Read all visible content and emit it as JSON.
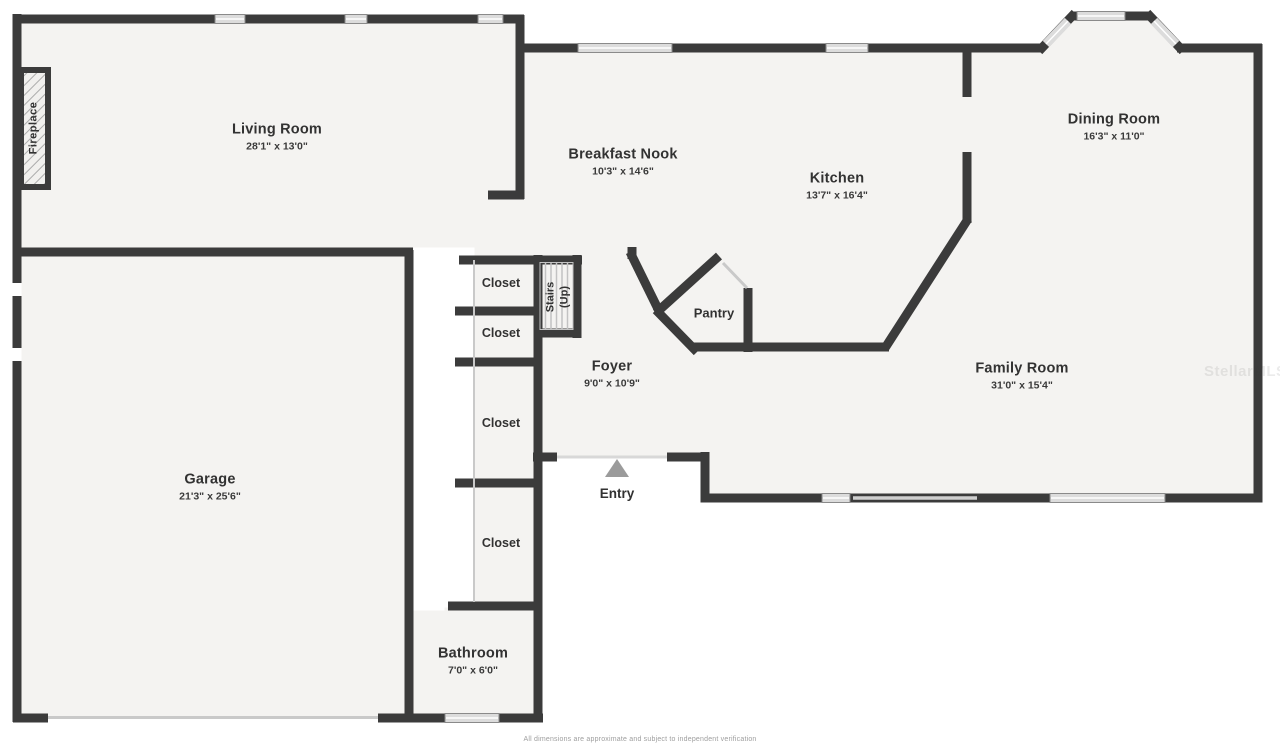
{
  "plan": {
    "rooms": [
      {
        "name": "Living Room",
        "dims": "28'1\" x 13'0\""
      },
      {
        "name": "Breakfast Nook",
        "dims": "10'3\" x 14'6\""
      },
      {
        "name": "Kitchen",
        "dims": "13'7\" x 16'4\""
      },
      {
        "name": "Dining Room",
        "dims": "16'3\" x 11'0\""
      },
      {
        "name": "Family Room",
        "dims": "31'0\" x 15'4\""
      },
      {
        "name": "Foyer",
        "dims": "9'0\" x 10'9\""
      },
      {
        "name": "Garage",
        "dims": "21'3\" x 25'6\""
      },
      {
        "name": "Bathroom",
        "dims": "7'0\" x 6'0\""
      }
    ],
    "pantry_label": "Pantry",
    "entry_label": "Entry",
    "closet_label": "Closet",
    "stairs_line1": "Stairs",
    "stairs_line2": "(Up)",
    "fireplace_label": "Fireplace",
    "watermark": "StellarMLS",
    "disclaimer": "All dimensions are approximate and subject to independent verification",
    "colors": {
      "wall": "#3b3b3b",
      "floor": "#f4f3f1",
      "window": "#dcdcdc",
      "window_frame": "#8a8a8a",
      "thin_line": "#c9c9c9",
      "entry_arrow": "#9b9b9b"
    }
  }
}
